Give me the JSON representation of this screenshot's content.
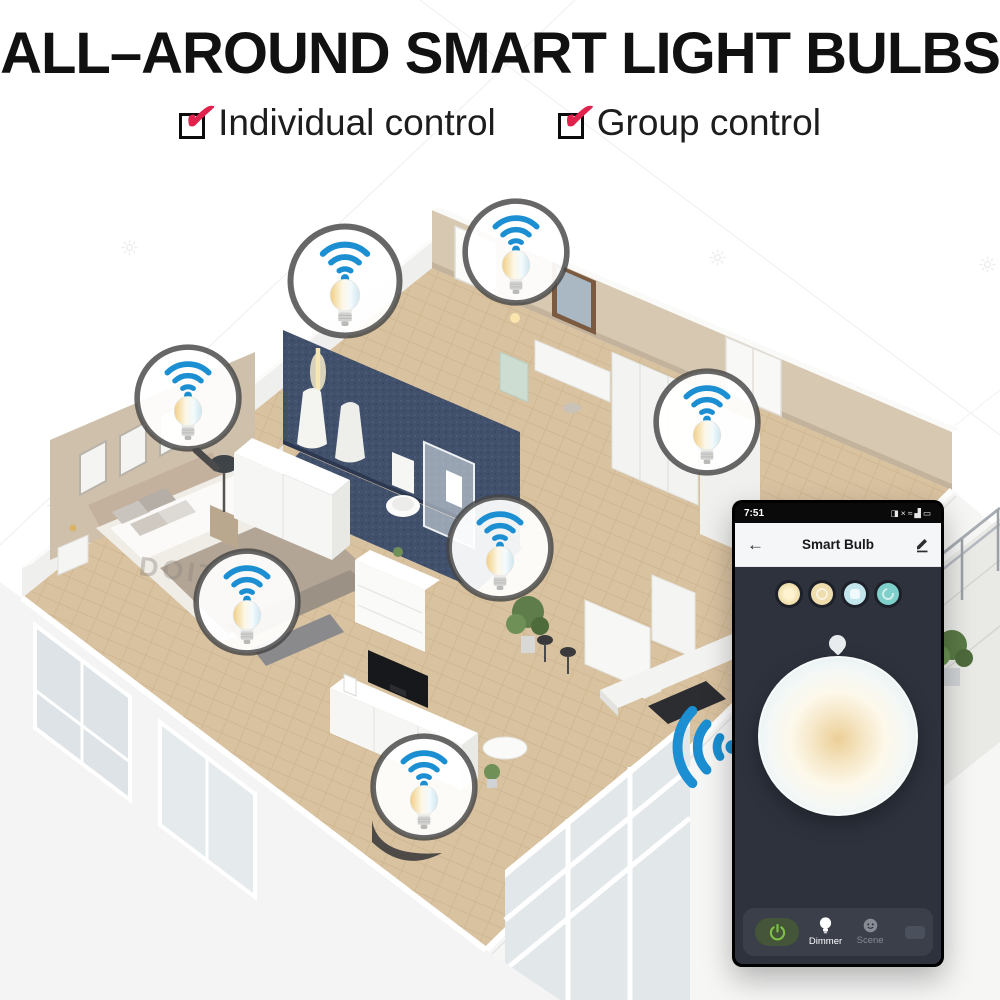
{
  "title": "ALL–AROUND SMART LIGHT BULBS",
  "checkboxes": [
    {
      "label": "Individual control",
      "check": "✔"
    },
    {
      "label": "Group control",
      "check": "✔"
    }
  ],
  "floorplan": {
    "watermark": "DOITING",
    "callouts": [
      {
        "name": "bathroom-pendant-bulb"
      },
      {
        "name": "bathroom-vanity-bulb"
      },
      {
        "name": "bedroom-wall-bulb"
      },
      {
        "name": "wardrobe-hall-bulb"
      },
      {
        "name": "hallway-bulb"
      },
      {
        "name": "bedside-bulb"
      },
      {
        "name": "living-room-bulb"
      }
    ],
    "icons": {
      "wifi": "wifi-signal",
      "bulb": "tunable-white-bulb"
    }
  },
  "phone": {
    "status_bar": {
      "time": "7:51",
      "icons": [
        {
          "name": "screenshot-icon",
          "glyph": "◨"
        },
        {
          "name": "mute-icon",
          "glyph": "×"
        },
        {
          "name": "vibrate-icon",
          "glyph": "≈"
        },
        {
          "name": "signal-icon",
          "glyph": "▟"
        },
        {
          "name": "battery-icon",
          "glyph": "▭"
        }
      ]
    },
    "nav": {
      "back_glyph": "←",
      "title": "Smart Bulb"
    },
    "bottom_bar": {
      "items": [
        {
          "label": "Dimmer"
        },
        {
          "label": "Scene"
        }
      ]
    },
    "colors": {
      "power_green": "#7dc242",
      "screen_dark": "#2d323d",
      "dock_gray": "#3a3f4a",
      "preset_warm": "#efddab",
      "preset_soft_warm": "#f0ddae",
      "preset_cool": "#c3e6ed",
      "preset_teal": "#7fcfca"
    }
  },
  "colors": {
    "check_red": "#e0224c",
    "wifi_blue": "#1b8fd2",
    "bathroom_tile_navy": "#41506b",
    "wall_beige": "#d7c8b2",
    "wood_floor": "#d9c29f"
  }
}
